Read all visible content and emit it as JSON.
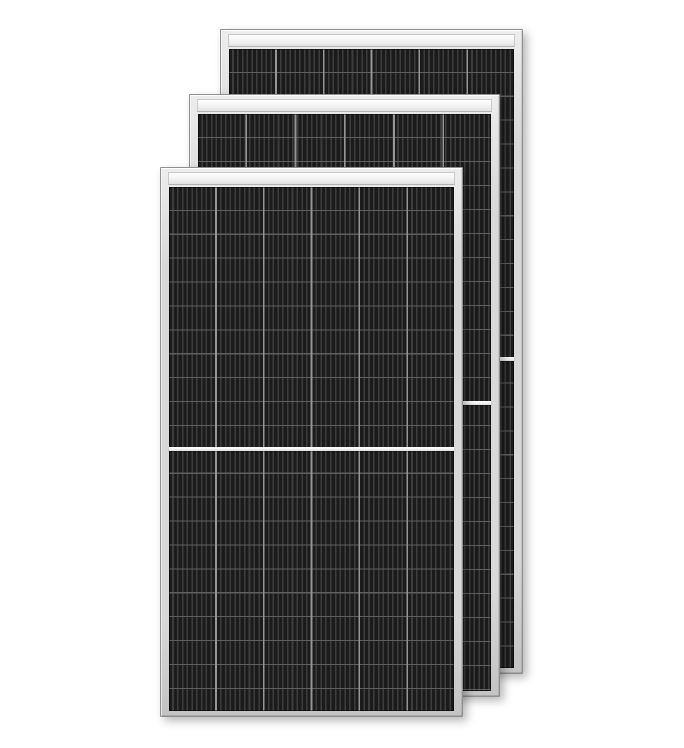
{
  "scene": {
    "type": "product-image",
    "subject": "Three overlapping half-cut monocrystalline solar panels on a white background",
    "text_content": "none"
  },
  "colors": {
    "background": "#ffffff",
    "frame": "#d8d8d8",
    "frame_light": "#ededed",
    "frame_dark": "#c3c3c3",
    "frame_border": "#8f8f8f",
    "top_strip": "#f2f2f2",
    "cell_base": "#232323",
    "cell_dark": "#1b1b1b",
    "cell_gap": "#3d3d3d",
    "column_line": "#969696",
    "row_line": "#5f5f5f",
    "divider": "#f1f1f1",
    "shadow": "rgba(0,0,0,0.28)"
  },
  "panels": [
    {
      "id": "solar-panel-back",
      "position": "back",
      "left": 220,
      "top": 29,
      "width": 303,
      "height": 645,
      "z_index": 1,
      "cell_columns": 6,
      "cell_rows_per_half": 13,
      "column_pitch_px": 47.8,
      "row_pitch_px": 23.9,
      "has_center_divider": true,
      "has_top_strip": true
    },
    {
      "id": "solar-panel-middle",
      "position": "middle",
      "left": 189,
      "top": 94,
      "width": 311,
      "height": 603,
      "z_index": 2,
      "cell_columns": 6,
      "cell_rows_per_half": 12,
      "column_pitch_px": 49.2,
      "row_pitch_px": 24.0,
      "has_center_divider": true,
      "has_top_strip": true
    },
    {
      "id": "solar-panel-front",
      "position": "front",
      "left": 160,
      "top": 167,
      "width": 303,
      "height": 550,
      "z_index": 3,
      "cell_columns": 6,
      "cell_rows_per_half": 11,
      "column_pitch_px": 47.8,
      "row_pitch_px": 23.9,
      "has_center_divider": true,
      "has_top_strip": true
    }
  ]
}
